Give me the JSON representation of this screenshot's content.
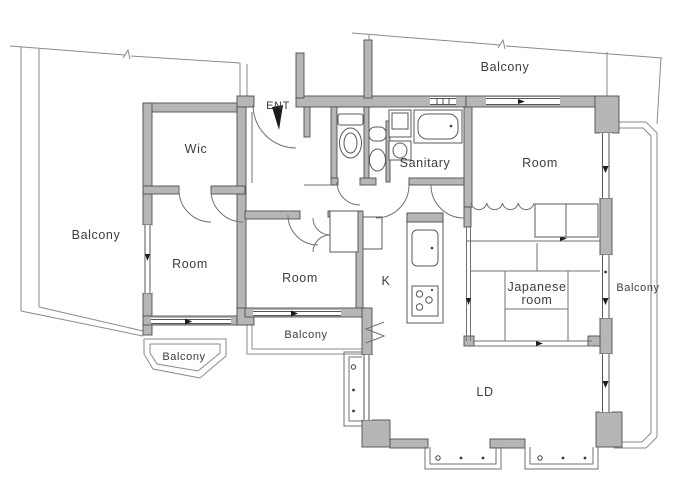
{
  "plan": {
    "type": "apartment-floor-plan",
    "colors": {
      "wall_fill": "#b6b6b6",
      "wall_stroke": "#4e4e4e",
      "line": "#707070",
      "text": "#3c3c3c",
      "background": "#ffffff",
      "entrance_arrow": "#1c1c1c"
    },
    "labels": {
      "ent": "ENT",
      "wic": "Wic",
      "sanitary": "Sanitary",
      "room_top_right": "Room",
      "room_left": "Room",
      "room_middle": "Room",
      "kitchen": "K",
      "japanese_room_line1": "Japanese",
      "japanese_room_line2": "room",
      "living_dining": "LD",
      "balcony_left": "Balcony",
      "balcony_top": "Balcony",
      "balcony_right": "Balcony",
      "balcony_bottom_left": "Balcony",
      "balcony_bottom_middle": "Balcony"
    }
  }
}
